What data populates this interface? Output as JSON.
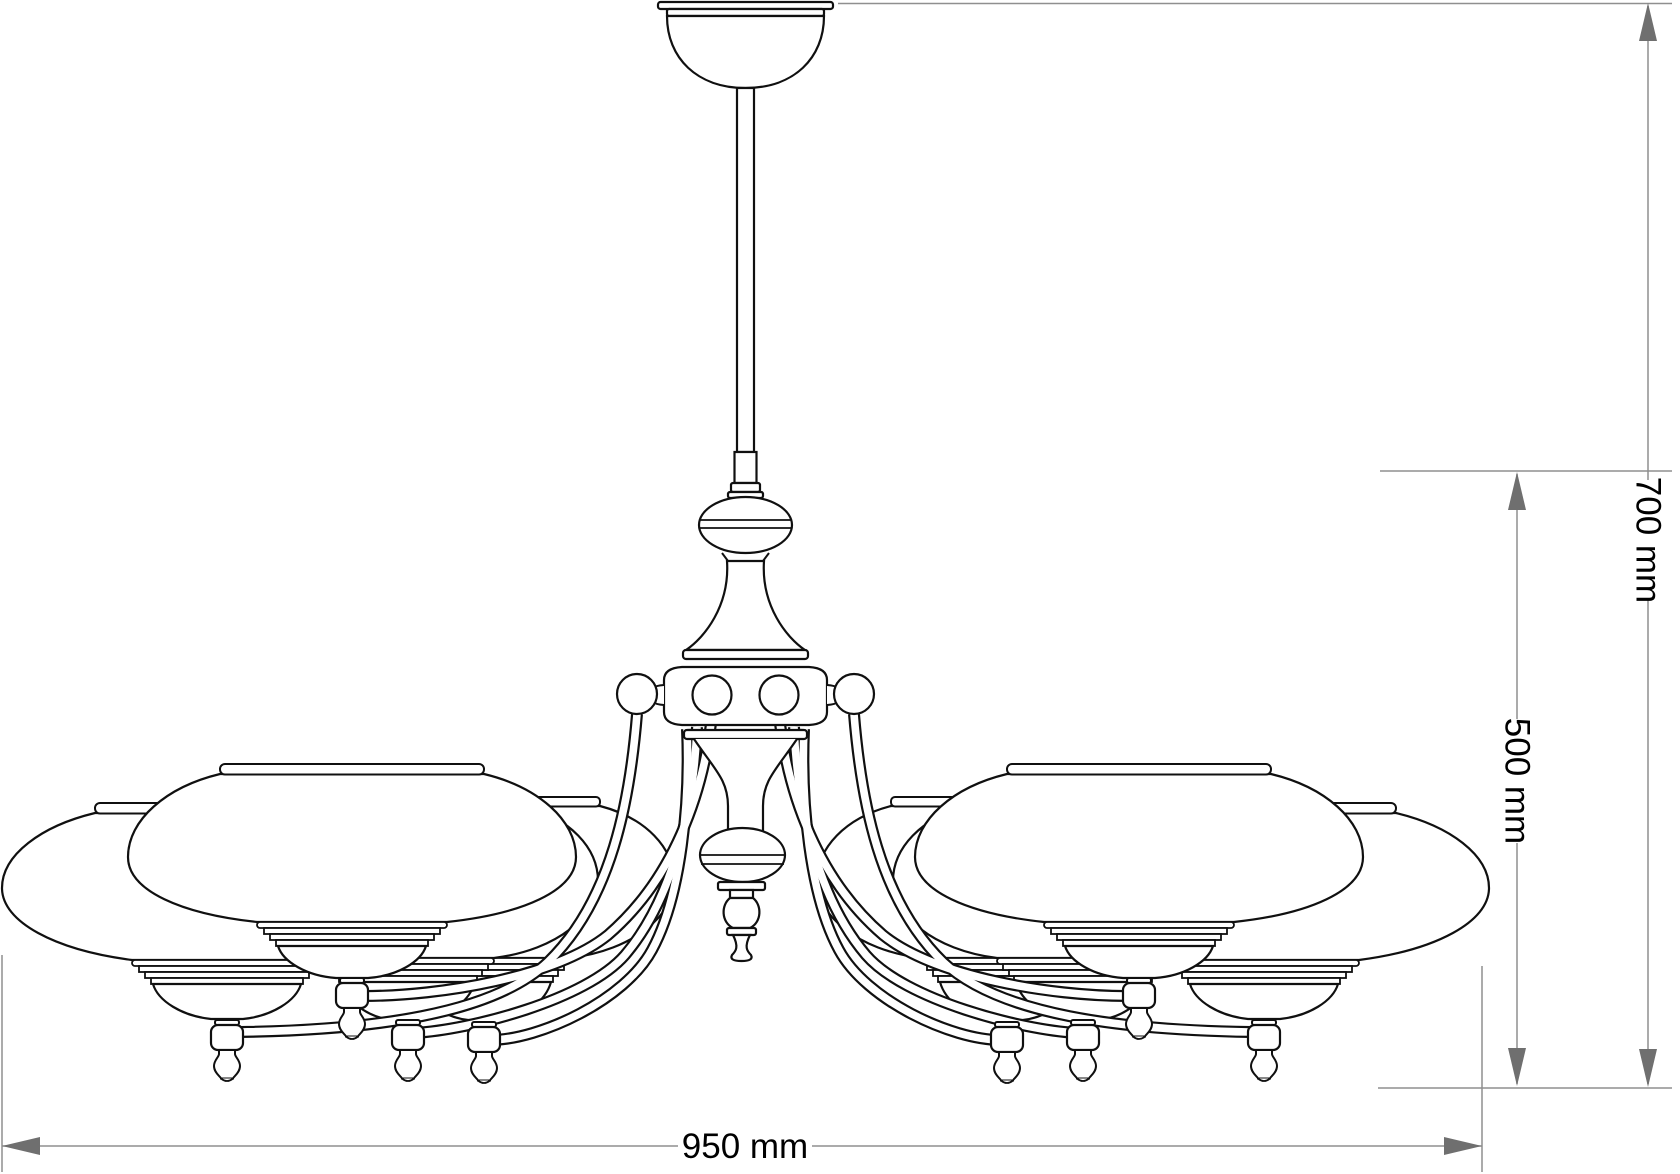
{
  "title": "Chandelier technical dimension drawing",
  "dimensions": {
    "width": "950 mm",
    "height_total": "700 mm",
    "height_body": "500 mm"
  },
  "style": {
    "outline_color": "#101010",
    "dimension_line_color": "#8f8f8f",
    "arrow_color": "#6f6f6f",
    "label_color": "#000000",
    "background": "#ffffff"
  },
  "parts": [
    "ceiling-canopy",
    "suspension-rod",
    "baluster-knob",
    "trumpet-stem",
    "arm-hub-with-balls",
    "eight-curved-arms",
    "glass-bowl-shades",
    "shade-holders-with-finials",
    "center-drop-finial"
  ]
}
